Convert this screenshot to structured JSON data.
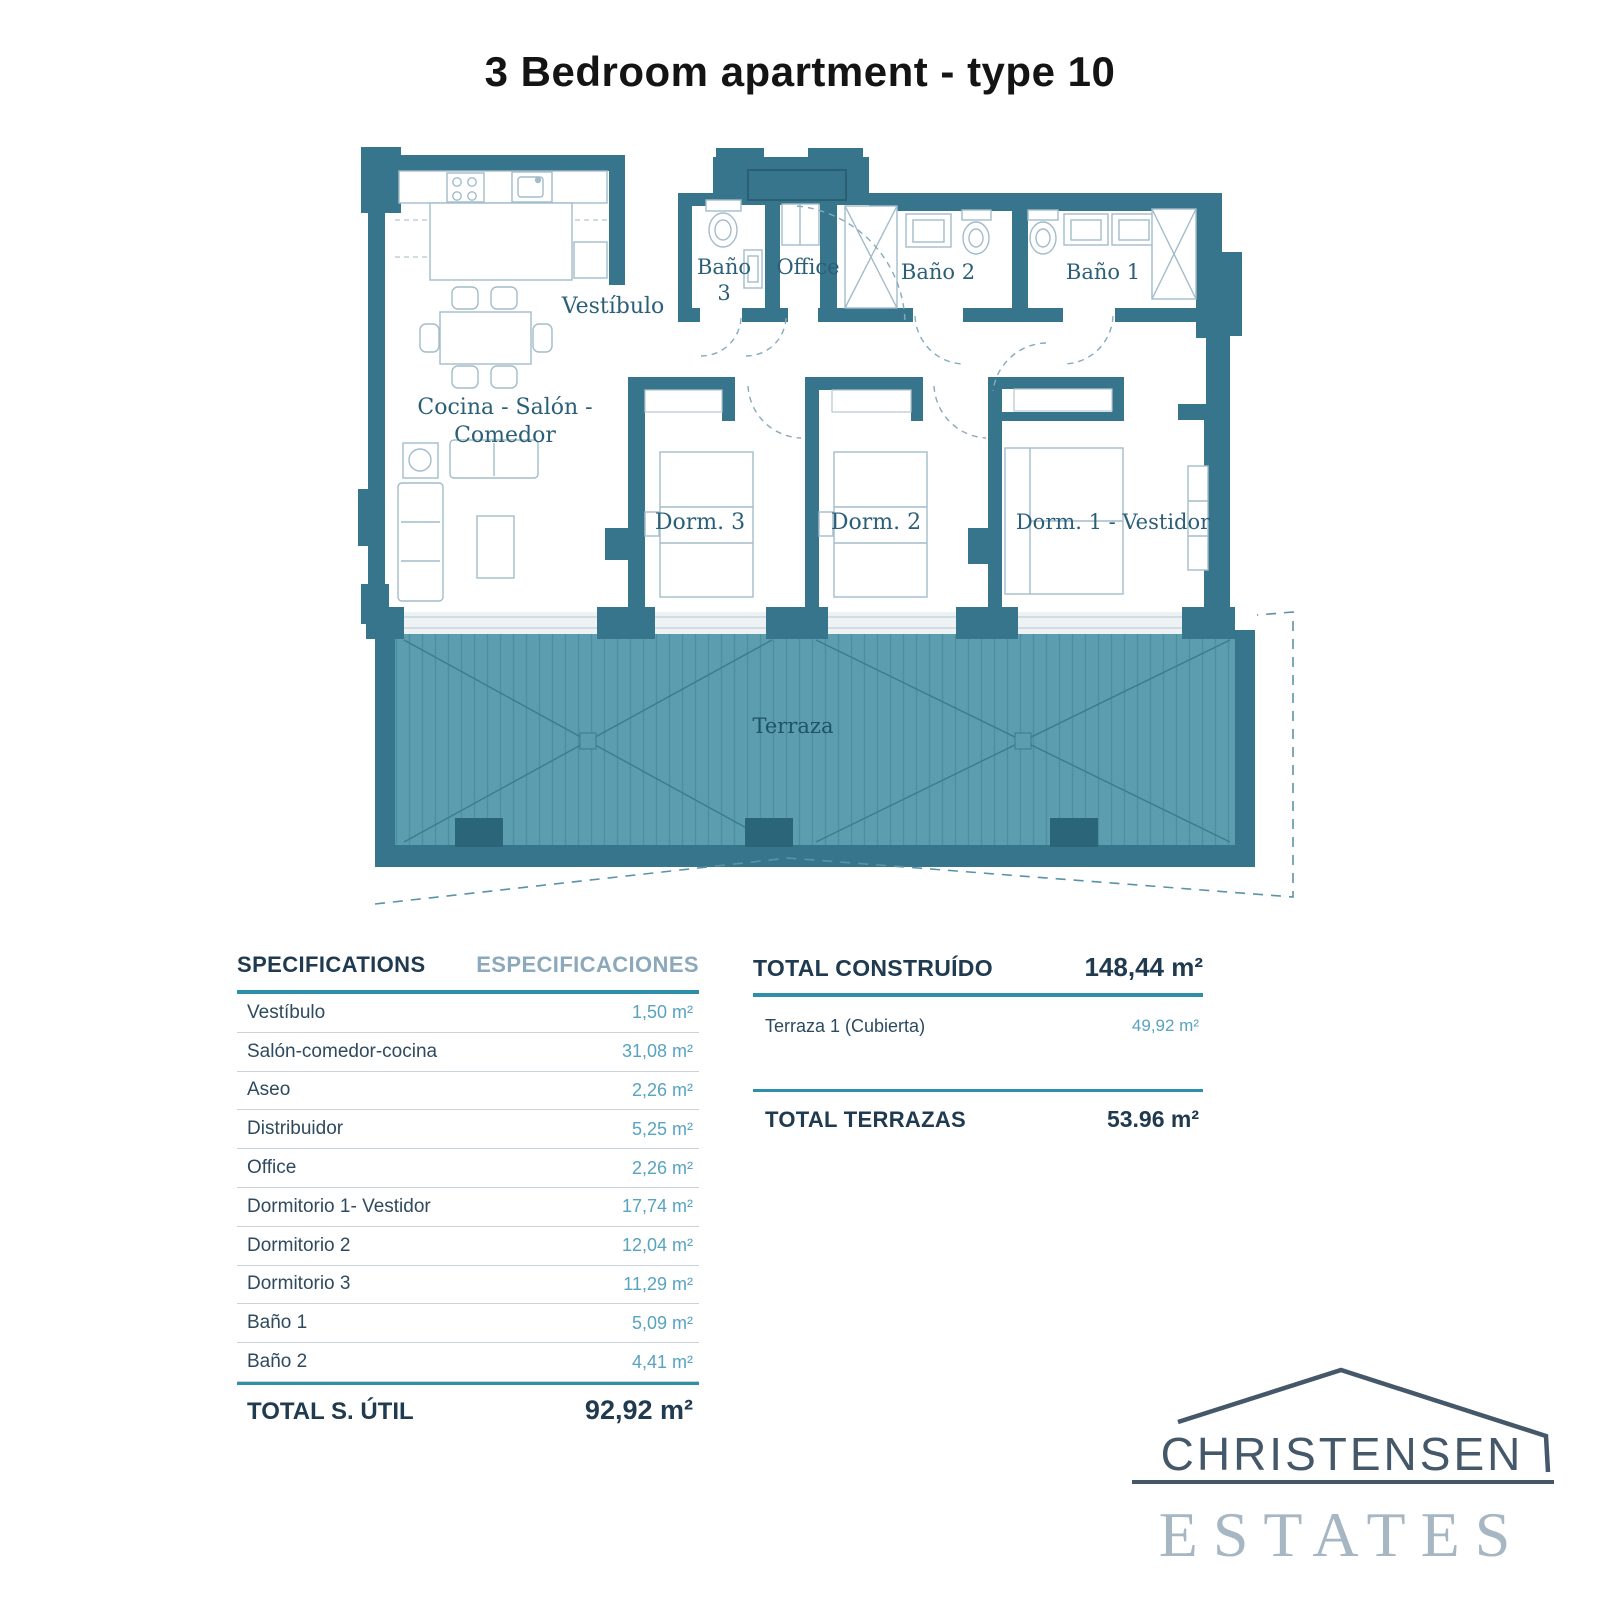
{
  "title": "3 Bedroom apartment - type 10",
  "plan": {
    "labels": {
      "vestibulo": "Vestíbulo",
      "bano3_line1": "Baño",
      "bano3_line2": "3",
      "office": "Office",
      "bano2": "Baño 2",
      "bano1": "Baño 1",
      "cocina_line1": "Cocina - Salón -",
      "cocina_line2": "Comedor",
      "dorm3": "Dorm. 3",
      "dorm2": "Dorm. 2",
      "dorm1": "Dorm. 1 - Vestidor",
      "terraza": "Terraza"
    }
  },
  "specs_table": {
    "header_en": "SPECIFICATIONS",
    "header_es": "ESPECIFICACIONES",
    "rows": [
      {
        "label": "Vestíbulo",
        "value": "1,50 m²"
      },
      {
        "label": "Salón-comedor-cocina",
        "value": "31,08 m²"
      },
      {
        "label": "Aseo",
        "value": "2,26 m²"
      },
      {
        "label": "Distribuidor",
        "value": "5,25 m²"
      },
      {
        "label": "Office",
        "value": "2,26 m²"
      },
      {
        "label": "Dormitorio 1- Vestidor",
        "value": "17,74 m²"
      },
      {
        "label": "Dormitorio 2",
        "value": "12,04 m²"
      },
      {
        "label": "Dormitorio 3",
        "value": "11,29 m²"
      },
      {
        "label": "Baño 1",
        "value": "5,09 m²"
      },
      {
        "label": "Baño 2",
        "value": "4,41 m²"
      }
    ],
    "total_label": "TOTAL S. ÚTIL",
    "total_value": "92,92 m²"
  },
  "totals_table": {
    "construido_label": "TOTAL CONSTRUÍDO",
    "construido_value": "148,44 m²",
    "terraza_label": "Terraza 1 (Cubierta)",
    "terraza_value": "49,92 m²",
    "terrazas_label": "TOTAL TERRAZAS",
    "terrazas_value": "53.96 m²"
  },
  "logo": {
    "line1": "CHRISTENSEN",
    "line2": "ESTATES"
  },
  "colors": {
    "wall_teal": "#36758C",
    "terrace_fill": "#5C9DAF",
    "accent_rule": "#2E8FA9",
    "table_dark": "#203A50",
    "table_value": "#57A3C0",
    "logo_dark": "#45586A",
    "logo_light": "#A6B7C3"
  }
}
